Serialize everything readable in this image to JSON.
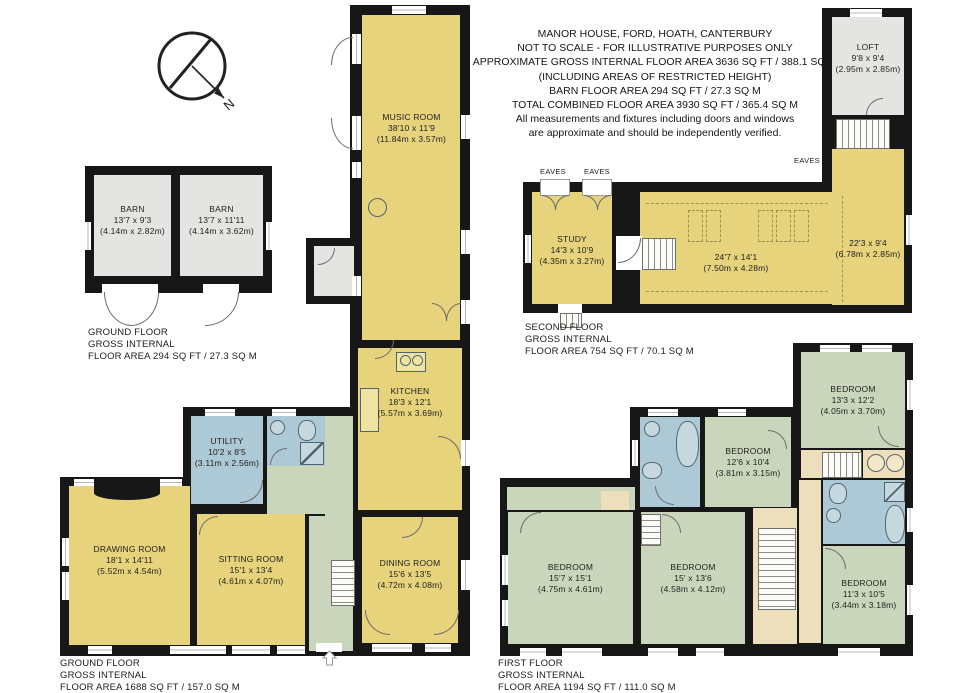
{
  "title_block": {
    "lines": [
      "MANOR HOUSE, FORD, HOATH, CANTERBURY",
      "NOT TO SCALE - FOR ILLUSTRATIVE PURPOSES ONLY",
      "APPROXIMATE GROSS INTERNAL FLOOR AREA 3636 SQ FT / 388.1 SQ M",
      "(INCLUDING AREAS OF RESTRICTED HEIGHT)",
      "BARN FLOOR AREA 294 SQ FT / 27.3 SQ M",
      "TOTAL COMBINED FLOOR AREA 3930 SQ FT / 365.4 SQ M",
      "All measurements and fixtures including doors and windows",
      "are approximate and should be independently verified."
    ]
  },
  "compass": {
    "label": "N"
  },
  "colors": {
    "wall": "#171717",
    "habitable_yellow": "#e6d37c",
    "outbuilding_gray": "#e4e4e2",
    "wet_room_blue": "#adc9d5",
    "bedroom_green": "#c9d6bc",
    "landing_tan": "#eedfbc"
  },
  "barn": {
    "rooms": [
      {
        "name": "BARN",
        "imperial": "13'7 x 9'3",
        "metric": "(4.14m x 2.82m)"
      },
      {
        "name": "BARN",
        "imperial": "13'7 x 11'11",
        "metric": "(4.14m x 3.62m)"
      }
    ],
    "caption": [
      "GROUND FLOOR",
      "GROSS INTERNAL",
      "FLOOR AREA 294 SQ FT / 27.3 SQ M"
    ]
  },
  "ground_floor": {
    "rooms": [
      {
        "name": "MUSIC ROOM",
        "imperial": "38'10 x 11'9",
        "metric": "(11.84m x 3.57m)"
      },
      {
        "name": "KITCHEN",
        "imperial": "18'3 x 12'1",
        "metric": "(5.57m x 3.69m)"
      },
      {
        "name": "DINING ROOM",
        "imperial": "15'6 x 13'5",
        "metric": "(4.72m x 4.08m)"
      },
      {
        "name": "UTILITY",
        "imperial": "10'2 x 8'5",
        "metric": "(3.11m x 2.56m)"
      },
      {
        "name": "DRAWING ROOM",
        "imperial": "18'1 x 14'11",
        "metric": "(5.52m x 4.54m)"
      },
      {
        "name": "SITTING ROOM",
        "imperial": "15'1 x 13'4",
        "metric": "(4.61m x 4.07m)"
      }
    ],
    "caption": [
      "GROUND FLOOR",
      "GROSS INTERNAL",
      "FLOOR AREA 1688 SQ FT / 157.0 SQ M"
    ]
  },
  "second_floor": {
    "eaves_labels": [
      "EAVES",
      "EAVES",
      "EAVES"
    ],
    "rooms": [
      {
        "name": "STUDY",
        "imperial": "14'3 x 10'9",
        "metric": "(4.35m x 3.27m)"
      },
      {
        "name": "",
        "imperial": "24'7 x 14'1",
        "metric": "(7.50m x 4.28m)"
      },
      {
        "name": "",
        "imperial": "22'3 x 9'4",
        "metric": "(6.78m x 2.85m)"
      },
      {
        "name": "LOFT",
        "imperial": "9'8 x 9'4",
        "metric": "(2.95m x 2.85m)"
      }
    ],
    "caption": [
      "SECOND FLOOR",
      "GROSS INTERNAL",
      "FLOOR AREA 754 SQ FT / 70.1 SQ M"
    ]
  },
  "first_floor": {
    "rooms": [
      {
        "name": "BEDROOM",
        "imperial": "13'3 x 12'2",
        "metric": "(4.05m x 3.70m)"
      },
      {
        "name": "BEDROOM",
        "imperial": "12'6 x 10'4",
        "metric": "(3.81m x 3.15m)"
      },
      {
        "name": "BEDROOM",
        "imperial": "15'7 x 15'1",
        "metric": "(4.75m x 4.61m)"
      },
      {
        "name": "BEDROOM",
        "imperial": "15' x 13'6",
        "metric": "(4.58m x 4.12m)"
      },
      {
        "name": "BEDROOM",
        "imperial": "11'3 x 10'5",
        "metric": "(3.44m x 3.18m)"
      }
    ],
    "caption": [
      "FIRST FLOOR",
      "GROSS INTERNAL",
      "FLOOR AREA 1194 SQ FT / 111.0 SQ M"
    ]
  }
}
